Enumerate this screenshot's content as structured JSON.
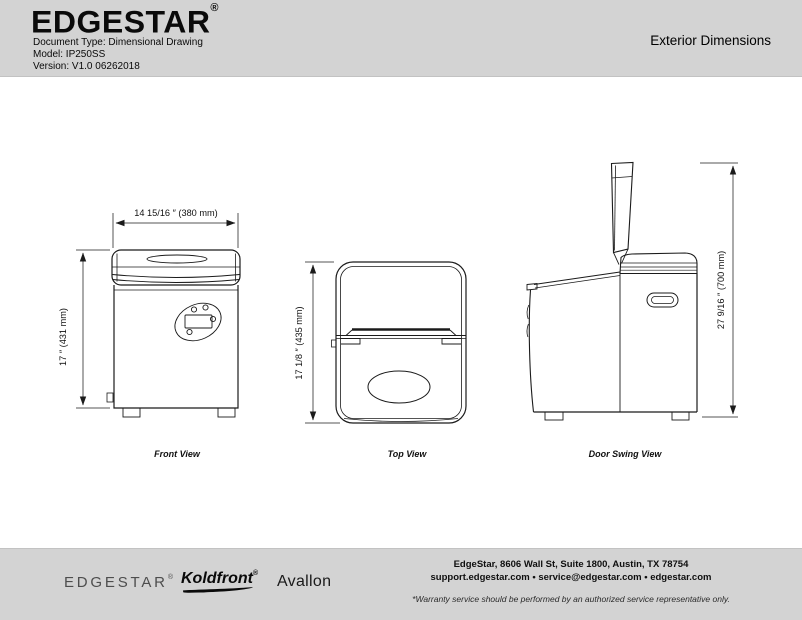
{
  "header": {
    "logo": "EDGESTAR",
    "registered_mark": "®",
    "doc_type": "Document Type: Dimensional Drawing",
    "model": "Model: IP250SS",
    "version": "Version: V1.0 06262018",
    "title": "Exterior Dimensions"
  },
  "views": {
    "front": {
      "label": "Front View",
      "width_dim": "14 15/16 ″ (380 mm)",
      "height_dim": "17 ″ (431 mm)"
    },
    "top": {
      "label": "Top View",
      "height_dim": "17 1/8 ″ (435 mm)"
    },
    "door_swing": {
      "label": "Door Swing View",
      "height_dim": "27 9/16 ″ (700 mm)"
    }
  },
  "footer": {
    "brands": [
      {
        "name": "EDGESTAR",
        "registered_mark": "®"
      },
      {
        "name": "Koldfront",
        "registered_mark": "®"
      },
      {
        "name": "Avallon",
        "registered_mark": ""
      }
    ],
    "address": "EdgeStar, 8606 Wall St, Suite 1800, Austin, TX 78754",
    "contacts": "support.edgestar.com   •   service@edgestar.com   •   edgestar.com",
    "warranty_note": "*Warranty service should be performed by an authorized service representative only."
  },
  "colors": {
    "band_bg": "#d3d3d3",
    "line": "#1b1b1b",
    "page_bg": "#ffffff"
  }
}
